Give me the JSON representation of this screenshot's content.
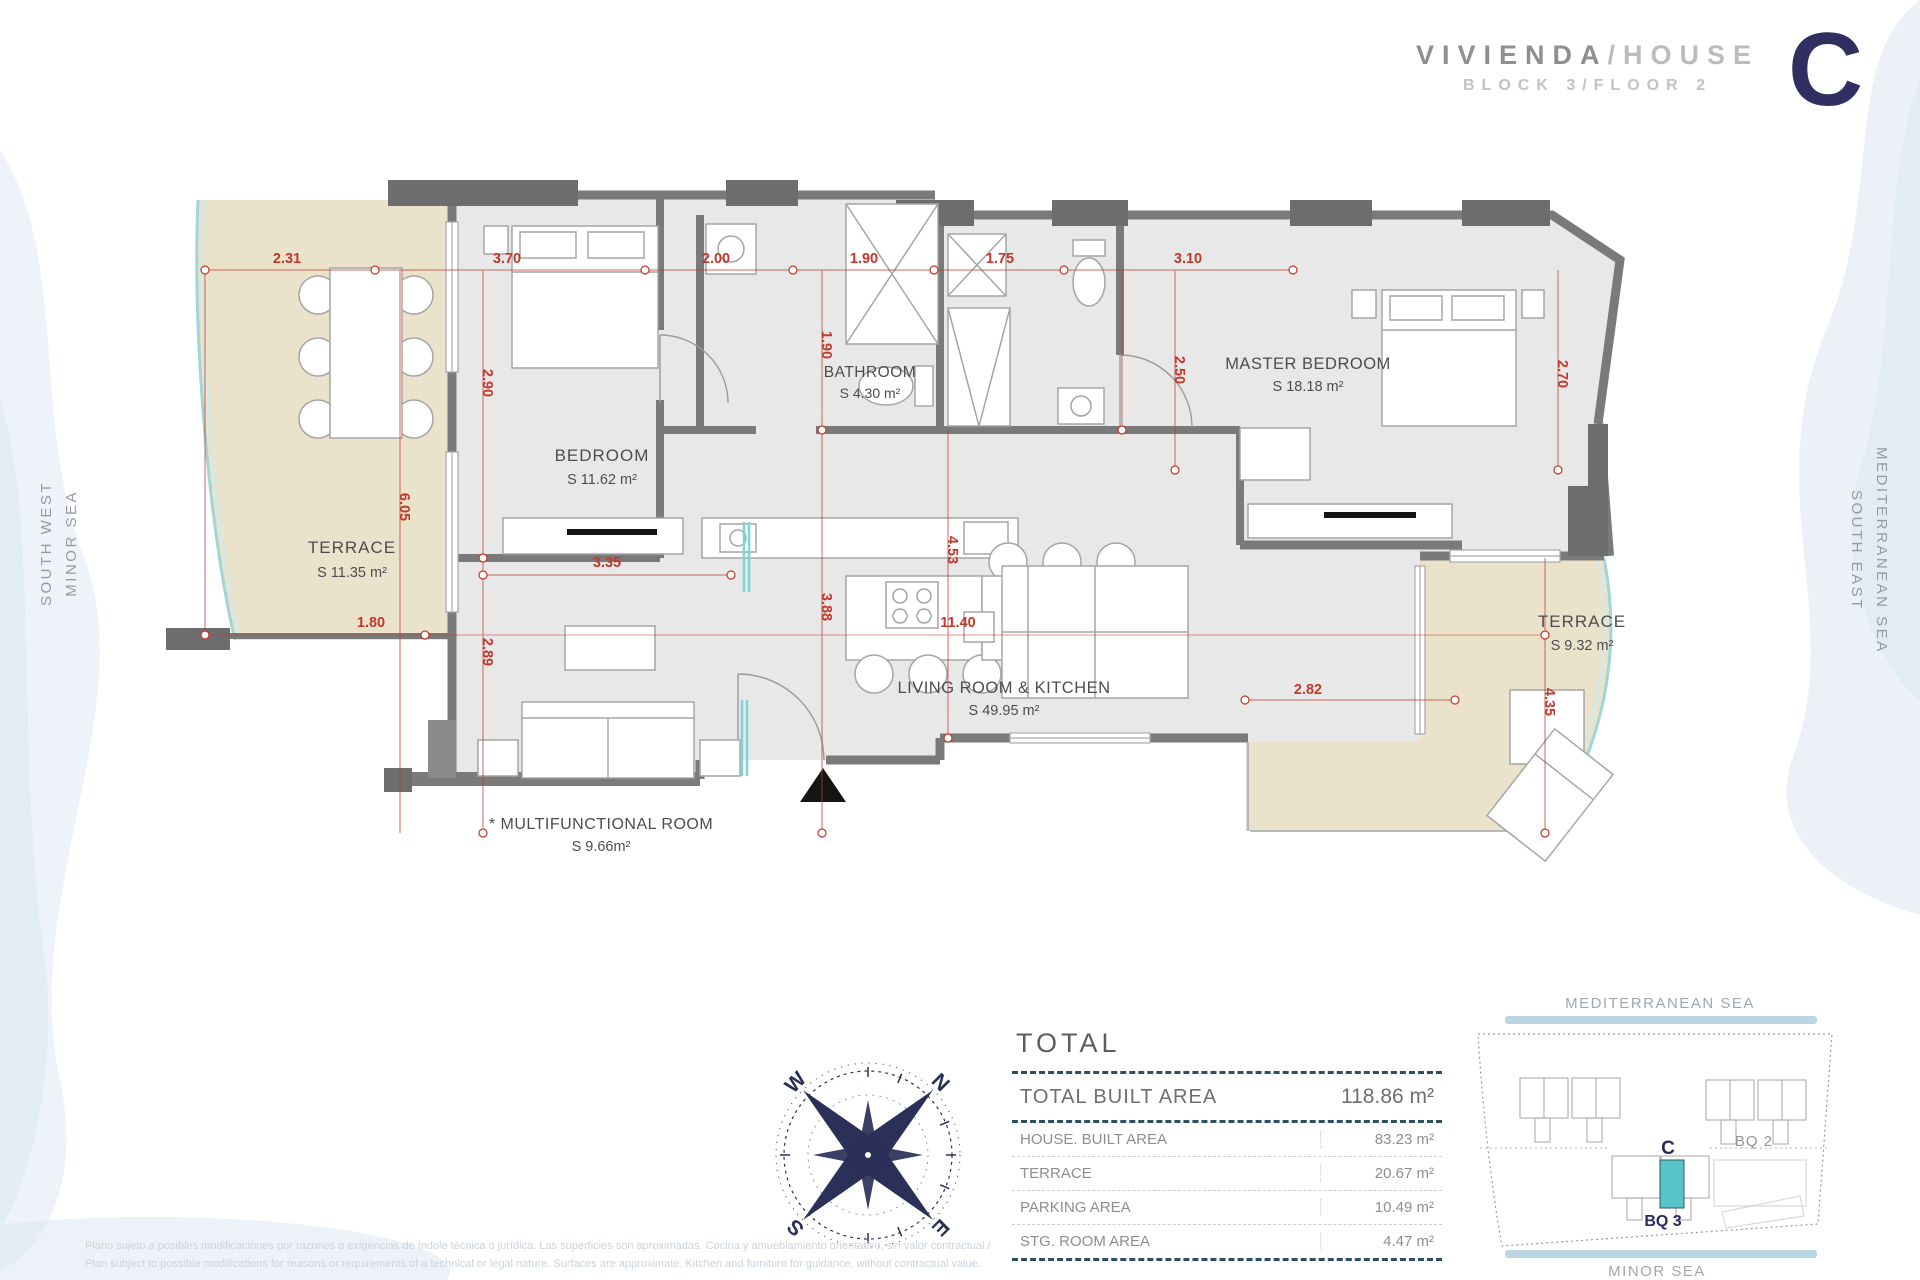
{
  "header": {
    "title_primary": "VIVIENDA",
    "title_separator": "/",
    "title_secondary": "HOUSE",
    "subtitle": "BLOCK 3/FLOOR 2",
    "unit_letter": "C"
  },
  "side_labels": {
    "left_line1": "SOUTH WEST",
    "left_line2": "MINOR SEA",
    "right_line1": "SOUTH EAST",
    "right_line2": "MEDITERRANEAN SEA"
  },
  "floor_plan": {
    "rooms": [
      {
        "name": "TERRACE",
        "area": "S 11.35 m²"
      },
      {
        "name": "BEDROOM",
        "area": "S 11.62 m²"
      },
      {
        "name": "BATHROOM",
        "area": "S 4.30 m²"
      },
      {
        "name": "MASTER BEDROOM",
        "area": "S 18.18 m²"
      },
      {
        "name": "LIVING ROOM & KITCHEN",
        "area": "S 49.95 m²"
      },
      {
        "name": "* MULTIFUNCTIONAL ROOM",
        "area": "S 9.66m²"
      },
      {
        "name": "TERRACE",
        "area": "S 9.32 m²"
      }
    ],
    "dims": [
      {
        "value": "2.31"
      },
      {
        "value": "3.70"
      },
      {
        "value": "2.00"
      },
      {
        "value": "1.90"
      },
      {
        "value": "1.75"
      },
      {
        "value": "3.10"
      },
      {
        "value": "2.90"
      },
      {
        "value": "1.90"
      },
      {
        "value": "2.50"
      },
      {
        "value": "2.70"
      },
      {
        "value": "6.05"
      },
      {
        "value": "3.35"
      },
      {
        "value": "1.80"
      },
      {
        "value": "2.89"
      },
      {
        "value": "3.88"
      },
      {
        "value": "11.40"
      },
      {
        "value": "4.53"
      },
      {
        "value": "4.35"
      },
      {
        "value": "2.82"
      }
    ]
  },
  "compass": {
    "n": "N",
    "e": "E",
    "s": "S",
    "w": "W"
  },
  "total_table": {
    "title": "TOTAL",
    "rows": [
      {
        "label": "TOTAL BUILT AREA",
        "value": "118.86 m²"
      },
      {
        "label": "HOUSE. BUILT AREA",
        "value": "83.23 m²"
      },
      {
        "label": "TERRACE",
        "value": "20.67 m²"
      },
      {
        "label": "PARKING AREA",
        "value": "10.49 m²"
      },
      {
        "label": "STG. ROOM AREA",
        "value": "4.47 m²"
      }
    ]
  },
  "site_map": {
    "sea_top": "MEDITERRANEAN SEA",
    "sea_bottom": "MINOR SEA",
    "block2_label": "BQ 2",
    "unit_label": "C",
    "block3_label": "BQ 3"
  },
  "disclaimer": {
    "line_es": "Plano sujeto a posibles modificaciones por razones o exigencias de índole técnica o jurídica. Las superficies son aproximadas. Cocina y amueblamiento orientativo, sin valor contractual./",
    "line_en": "Plan subject to possible modifications for reasons or requirements of a technical or legal nature. Surfaces are approximate. Kitchen and furniture for guidance, without contractual value."
  },
  "colors": {
    "accent_navy": "#312f62",
    "dimension_red": "#c0392b",
    "terrace_beige": "#eae2cb",
    "wall_gray": "#7a7a7a",
    "room_gray": "#e8e8e8",
    "unit_teal": "#56c4c8",
    "sea_bar_blue": "#b9d6e2"
  }
}
